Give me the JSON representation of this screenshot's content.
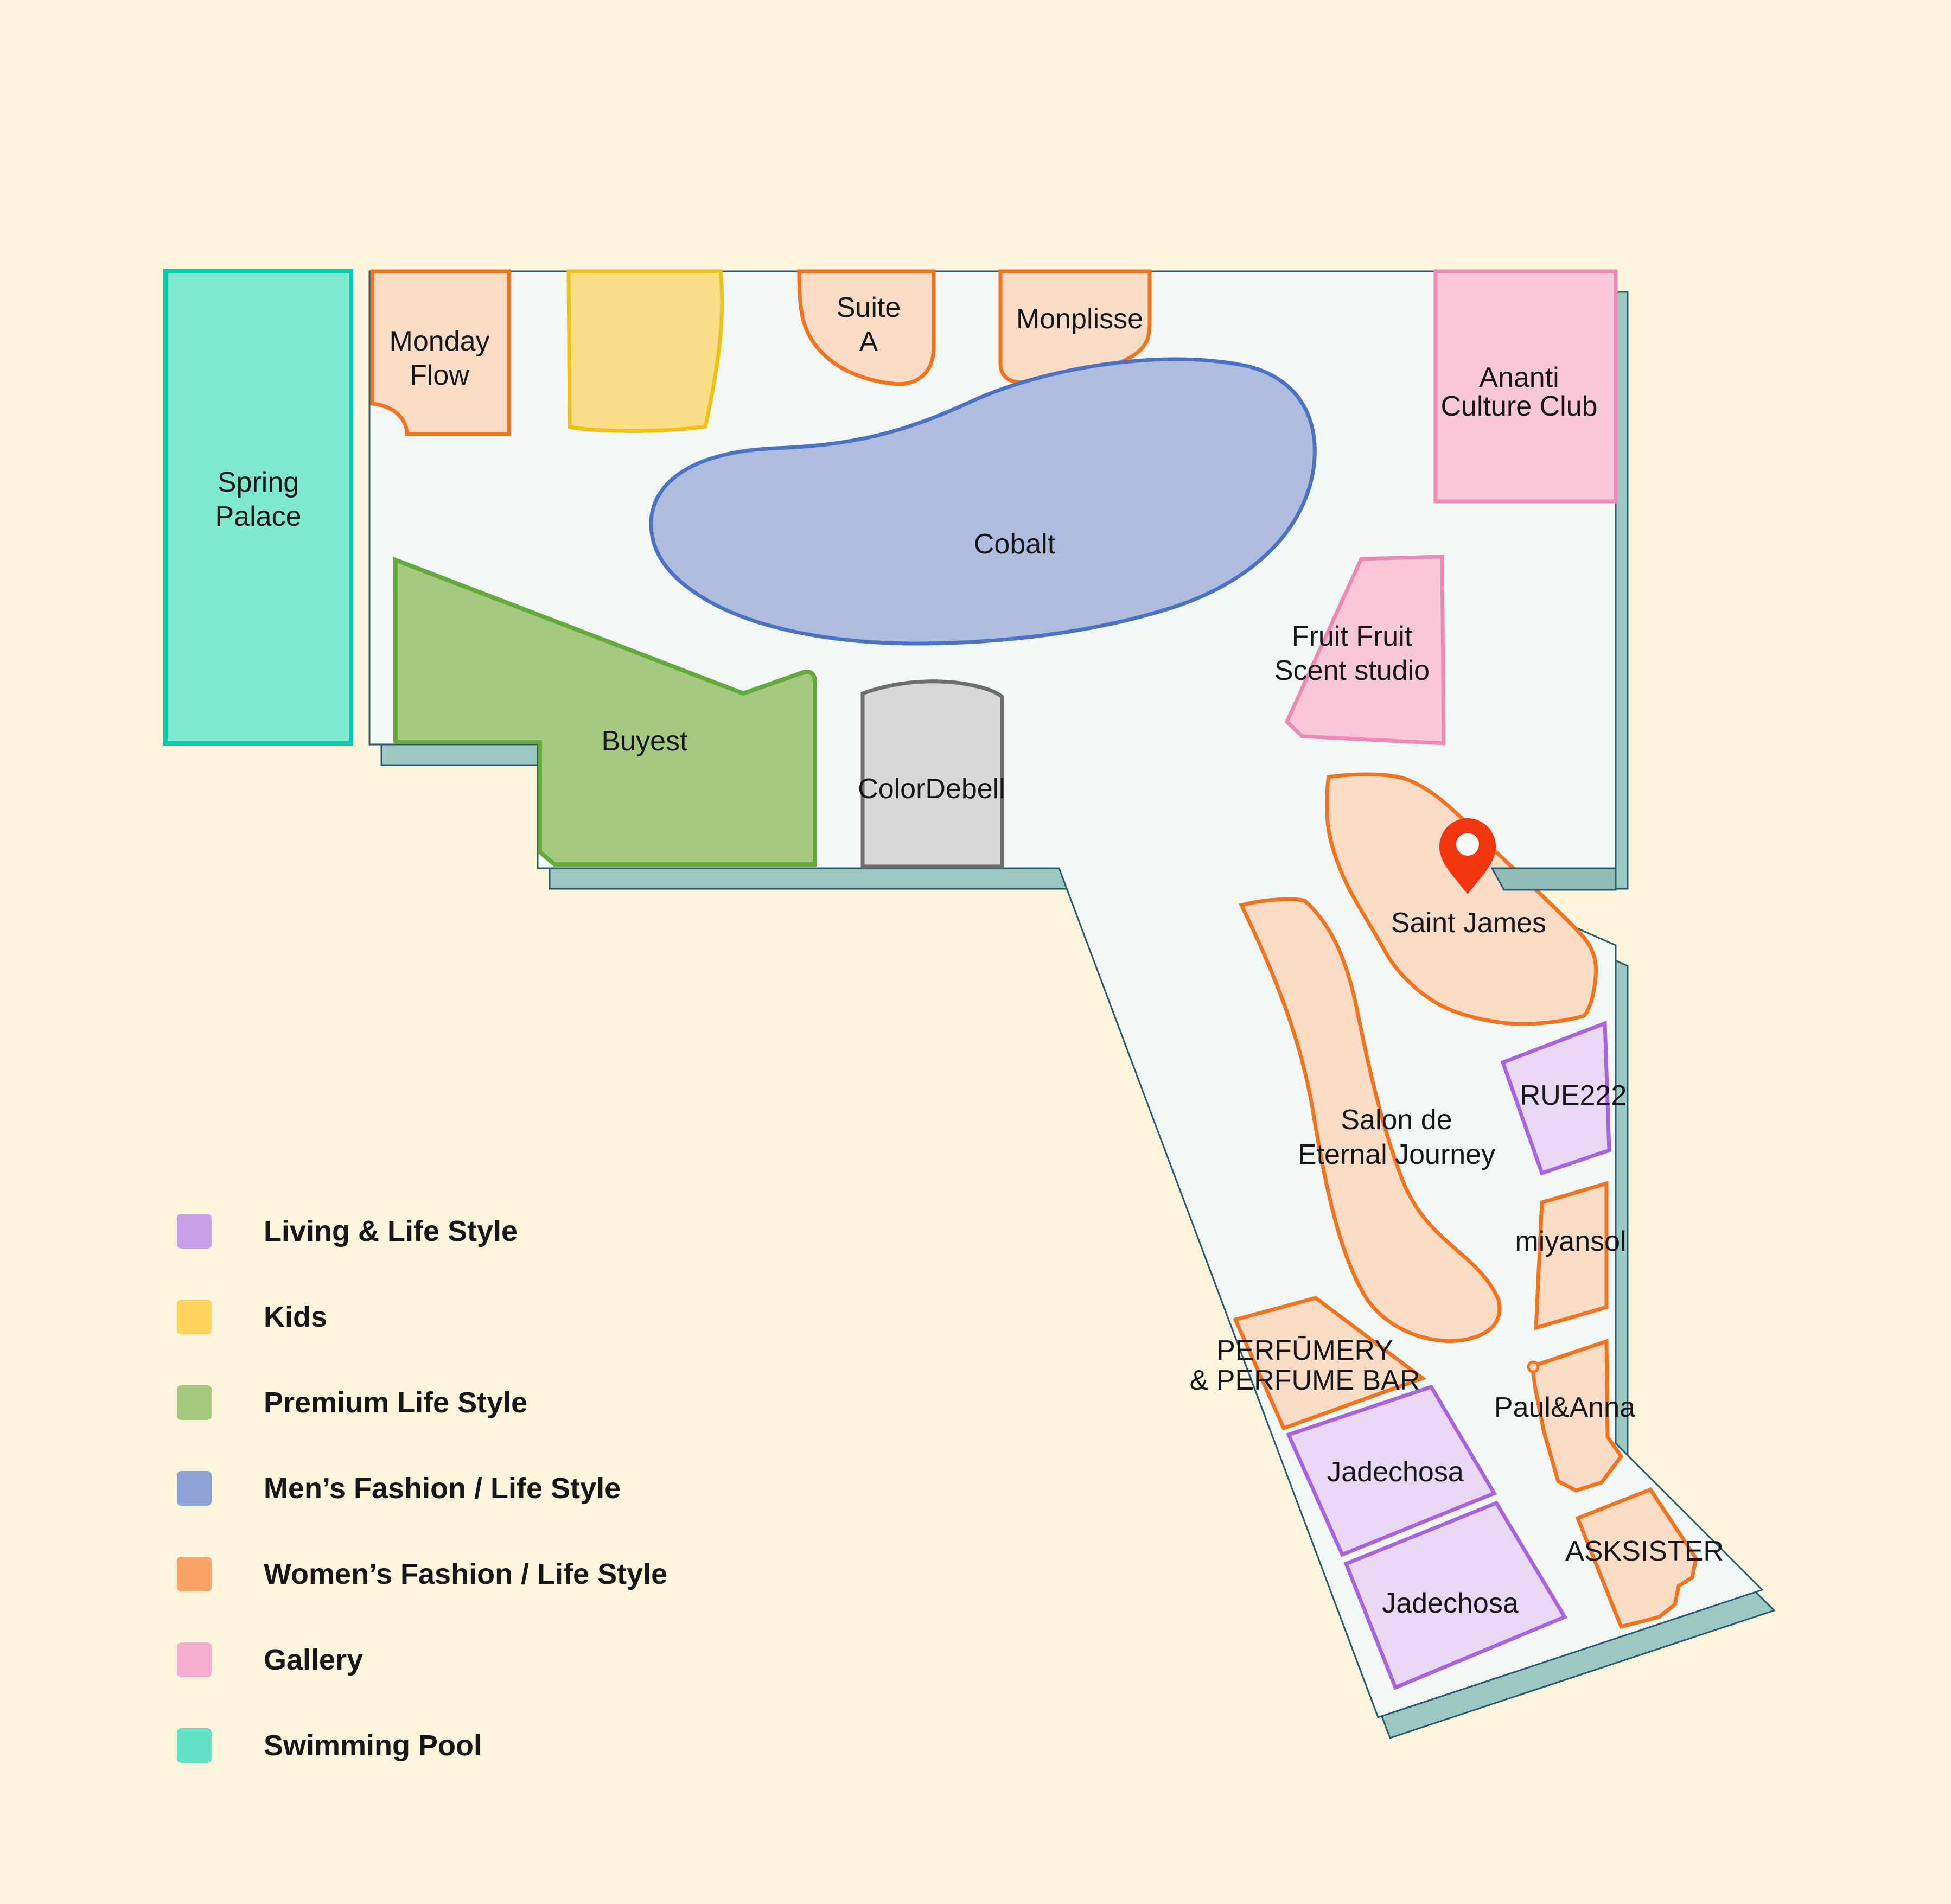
{
  "palette": {
    "background": "#fdf5dc",
    "floor_surface": "#f2f8f8",
    "floor_edge_3d": "#9cc8c2",
    "floor_outline": "#2a5a70",
    "pin_red": "#f2350f",
    "womens_fashion_fill": "#fadcc6",
    "womens_fashion_stroke": "#f4731d",
    "living_fill": "#e9d7f6",
    "living_stroke": "#a864e0",
    "kids_fill": "#fbdf88",
    "kids_stroke": "#f2bf16",
    "premium_fill": "#a6c981",
    "premium_stroke": "#65a93b",
    "mens_fill": "#aebddf",
    "mens_stroke": "#4c72c4",
    "gallery_fill": "#f8c7d9",
    "gallery_stroke": "#f088b6",
    "pool_fill": "#7fe9d0",
    "pool_stroke": "#0fc7ad",
    "gray_fill": "#d8d8d8",
    "gray_stroke": "#6d6d6d"
  },
  "map": {
    "pin": {
      "color": "#f2350f"
    },
    "stores": {
      "spring_palace": {
        "line1": "Spring",
        "line2": "Palace"
      },
      "monday_flow": {
        "line1": "Monday",
        "line2": "Flow"
      },
      "suite_a": {
        "line1": "Suite",
        "line2": "A"
      },
      "monplisse": {
        "label": "Monplisse"
      },
      "ananti_culture_club": {
        "line1": "Ananti",
        "line2": "Culture Club"
      },
      "cobalt": {
        "label": "Cobalt"
      },
      "fruit_fruit_scent_studio": {
        "line1": "Fruit Fruit",
        "line2": "Scent studio"
      },
      "buyest": {
        "label": "Buyest"
      },
      "colordebell": {
        "label": "ColorDebell"
      },
      "saint_james": {
        "label": "Saint James"
      },
      "salon_de_eternal_journey": {
        "line1": "Salon de",
        "line2": "Eternal Journey"
      },
      "rue222": {
        "label": "RUE222"
      },
      "miyansol": {
        "label": "miyansol"
      },
      "perfumery_perfume_bar": {
        "line1": "PERFŪMERY",
        "line2": "& PERFUME BAR"
      },
      "paul_anna": {
        "label": "Paul&Anna"
      },
      "jadechosa_upper": {
        "label": "Jadechosa"
      },
      "jadechosa_lower": {
        "label": "Jadechosa"
      },
      "asksister": {
        "label": "ASKSISTER"
      }
    }
  },
  "legend": {
    "items": [
      {
        "label": "Living & Life Style",
        "color": "#c9a0e8"
      },
      {
        "label": "Kids",
        "color": "#fcd45e"
      },
      {
        "label": "Premium Life Style",
        "color": "#a4c87e"
      },
      {
        "label": "Men’s Fashion / Life Style",
        "color": "#8ca3d3"
      },
      {
        "label": "Women’s Fashion / Life Style",
        "color": "#f9a469"
      },
      {
        "label": "Gallery",
        "color": "#f6aecf"
      },
      {
        "label": "Swimming Pool",
        "color": "#63e3c5"
      }
    ]
  }
}
